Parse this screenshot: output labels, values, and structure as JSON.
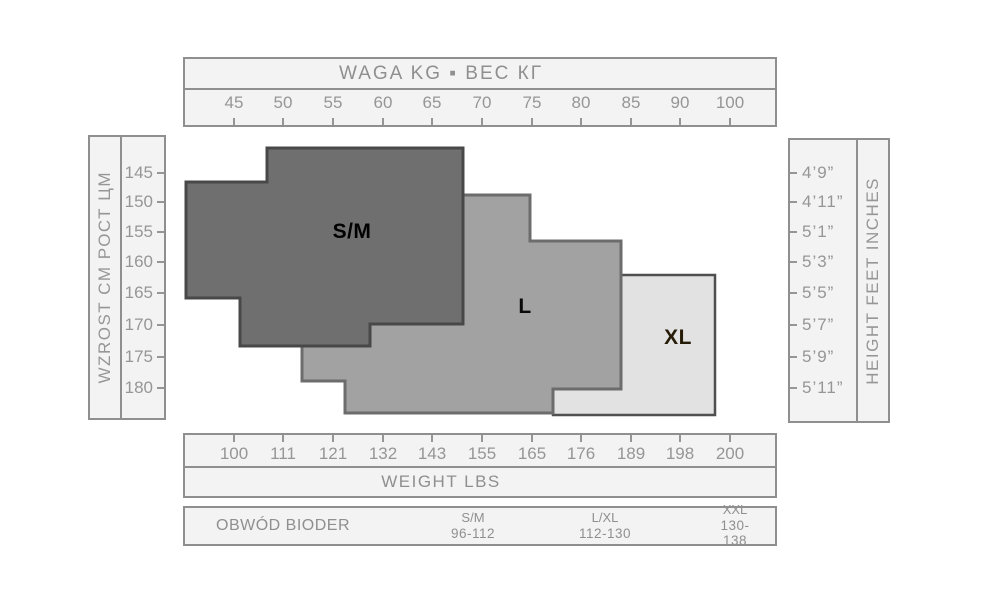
{
  "page": {
    "background": "#ffffff"
  },
  "top_axis": {
    "title": "WAGA  KG ▪ ВЕС КГ",
    "tick_labels": [
      "45",
      "50",
      "55",
      "60",
      "65",
      "70",
      "75",
      "80",
      "85",
      "90",
      "100"
    ]
  },
  "bottom_axis": {
    "title": "WEIGHT  LBS",
    "tick_labels": [
      "100",
      "111",
      "121",
      "132",
      "143",
      "155",
      "165",
      "176",
      "189",
      "198",
      "200"
    ]
  },
  "left_axis": {
    "label": "WZROST CM  РОСТ ЦМ",
    "tick_labels": [
      "145",
      "150",
      "155",
      "160",
      "165",
      "170",
      "175",
      "180"
    ]
  },
  "right_axis": {
    "label": "HEIGHT  FEET  INCHES",
    "tick_labels": [
      "4’9”",
      "4’11”",
      "5’1”",
      "5’3”",
      "5’5”",
      "5’7”",
      "5’9”",
      "5’11”"
    ]
  },
  "hip_table": {
    "row_label": "OBWÓD BIODER",
    "columns": [
      {
        "size": "S/M",
        "range": "96-112"
      },
      {
        "size": "L/XL",
        "range": "112-130"
      },
      {
        "size": "XXL",
        "range": "130-138"
      }
    ]
  },
  "colors": {
    "box_fill": "#f3f3f3",
    "box_border": "#8f8f8f",
    "axis_text": "#969696"
  },
  "chart_data": {
    "type": "area",
    "title": "Hosiery size chart: stepped size regions plotted over weight and height axes",
    "x_axis_top": {
      "title": "WAGA  KG ▪ ВЕС КГ",
      "unit": "kg",
      "ticks": [
        45,
        50,
        55,
        60,
        65,
        70,
        75,
        80,
        85,
        90,
        100
      ]
    },
    "x_axis_bottom": {
      "title": "WEIGHT  LBS",
      "unit": "lbs",
      "ticks": [
        100,
        111,
        121,
        132,
        143,
        155,
        165,
        176,
        189,
        198,
        200
      ]
    },
    "y_axis_left": {
      "title": "WZROST CM  РОСТ ЦМ",
      "unit": "cm",
      "ticks": [
        145,
        150,
        155,
        160,
        165,
        170,
        175,
        180
      ]
    },
    "y_axis_right": {
      "title": "HEIGHT  FEET  INCHES",
      "unit": "feet-inches",
      "ticks": [
        "4’9”",
        "4’11”",
        "5’1”",
        "5’3”",
        "5’5”",
        "5’7”",
        "5’9”",
        "5’11”"
      ]
    },
    "grid": false,
    "calibration": {
      "x_tick_px": [
        234,
        283,
        333,
        383,
        432,
        482,
        532,
        581,
        631,
        680,
        730
      ],
      "y_tick_px": [
        173,
        202,
        232,
        262,
        293,
        325,
        357,
        388
      ]
    },
    "regions": [
      {
        "name": "XL",
        "label": "XL",
        "fill": "#e2e2e2",
        "stroke": "#4f4f4f",
        "stroke_width": 2.5,
        "label_color": "#261c08",
        "label_px": [
          678,
          338
        ],
        "points_px": [
          [
            621,
            275
          ],
          [
            715,
            275
          ],
          [
            715,
            415
          ],
          [
            553,
            415
          ],
          [
            553,
            389
          ],
          [
            621,
            389
          ]
        ]
      },
      {
        "name": "L",
        "label": "L",
        "fill": "#a2a2a2",
        "stroke": "#6c6c6c",
        "stroke_width": 3,
        "label_color": "#0a0a0a",
        "label_px": [
          525,
          307
        ],
        "points_px": [
          [
            463,
            195
          ],
          [
            530,
            195
          ],
          [
            530,
            241
          ],
          [
            621,
            241
          ],
          [
            621,
            389
          ],
          [
            553,
            389
          ],
          [
            553,
            413
          ],
          [
            345,
            413
          ],
          [
            345,
            381
          ],
          [
            302,
            381
          ],
          [
            302,
            338
          ],
          [
            370,
            338
          ],
          [
            370,
            320
          ],
          [
            463,
            320
          ]
        ]
      },
      {
        "name": "S/M",
        "label": "S/M",
        "fill": "#6f6f6f",
        "stroke": "#484848",
        "stroke_width": 3,
        "label_color": "#000000",
        "label_px": [
          352,
          232
        ],
        "points_px": [
          [
            267,
            148
          ],
          [
            463,
            148
          ],
          [
            463,
            324
          ],
          [
            370,
            324
          ],
          [
            370,
            346
          ],
          [
            240,
            346
          ],
          [
            240,
            298
          ],
          [
            186,
            298
          ],
          [
            186,
            182
          ],
          [
            267,
            182
          ]
        ]
      }
    ],
    "hip_circumference_cm": {
      "S/M": "96-112",
      "L/XL": "112-130",
      "XXL": "130-138"
    }
  }
}
